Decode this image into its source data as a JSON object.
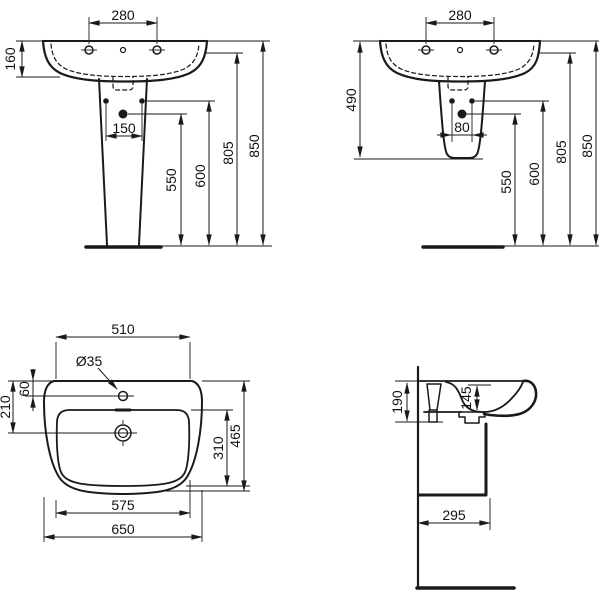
{
  "drawing": {
    "title": "Pedestal washbasin installation dimensions",
    "palette": {
      "line": "#1a1a1a",
      "background": "#ffffff"
    },
    "views": {
      "front_full_pedestal": {
        "label": "front view with full pedestal",
        "dims": {
          "taphole_spacing": "280",
          "front_height": "160",
          "outlet_spacing": "150",
          "outlet_height": "550",
          "fixing_height": "600",
          "taphole_height": "805",
          "rim_height": "850"
        }
      },
      "front_semi_pedestal": {
        "label": "front view with semi-pedestal",
        "dims": {
          "taphole_spacing": "280",
          "pedestal_height": "490",
          "outlet_spacing": "80",
          "outlet_height": "550",
          "fixing_height": "600",
          "taphole_height": "805",
          "rim_height": "850"
        }
      },
      "plan": {
        "label": "plan view",
        "dims": {
          "top_width": "510",
          "taphole_diameter": "Ø35",
          "taphole_offset": "60",
          "outlet_offset": "210",
          "bowl_depth": "310",
          "overall_depth": "465",
          "bowl_width": "575",
          "overall_width": "650"
        }
      },
      "side": {
        "label": "side section view",
        "dims": {
          "back_height": "190",
          "bowl_inner_depth": "145",
          "depth_projection": "295"
        }
      }
    }
  }
}
